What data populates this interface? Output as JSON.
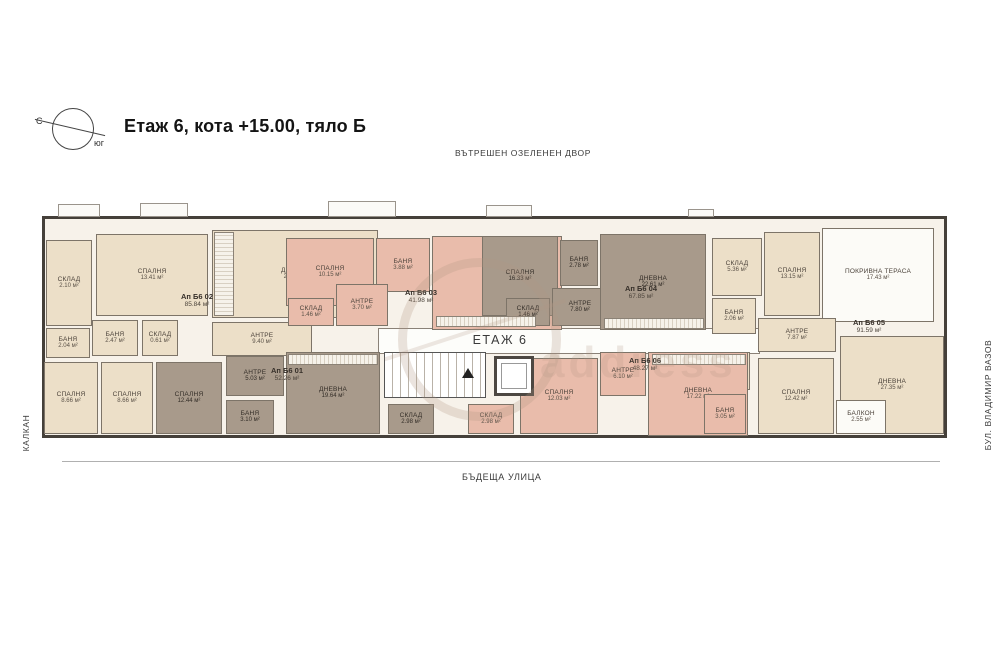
{
  "header": {
    "compass_north": "С",
    "compass_south": "юг",
    "title": "Етаж 6, кота +15.00, тяло Б"
  },
  "surroundings": {
    "top": "ВЪТРЕШЕН ОЗЕЛЕНЕН ДВОР",
    "bottom": "БЪДЕЩА УЛИЦА",
    "left": "КАЛКАН",
    "right": "БУЛ. ВЛАДИМИР ВАЗОВ"
  },
  "core": {
    "floor_label": "ЕТАЖ 6"
  },
  "watermark": "address",
  "colors": {
    "cream": "#ecdfc8",
    "salmon": "#e9bcab",
    "taupe": "#a89a8b",
    "wall": "#45403a"
  },
  "apartments": [
    {
      "id": "Ап Б6 01",
      "total_area": "52.26 м²",
      "rooms": [
        {
          "name": "СПАЛНЯ",
          "area": "12.44 м²"
        },
        {
          "name": "АНТРЕ",
          "area": "5.03 м²"
        },
        {
          "name": "БАНЯ",
          "area": "3.10 м²"
        },
        {
          "name": "ДНЕВНА",
          "area": "19.64 м²"
        },
        {
          "name": "СКЛАД",
          "area": "2.98 м²"
        }
      ]
    },
    {
      "id": "Ап Б6 02",
      "total_area": "85.84 м²",
      "rooms": [
        {
          "name": "СКЛАД",
          "area": "2.10 м²"
        },
        {
          "name": "СПАЛНЯ",
          "area": "13.41 м²"
        },
        {
          "name": "ДНЕВНА",
          "area": "22.98 м²"
        },
        {
          "name": "БАНЯ",
          "area": "2.47 м²"
        },
        {
          "name": "СКЛАД",
          "area": "0.61 м²"
        },
        {
          "name": "АНТРЕ",
          "area": "9.40 м²"
        },
        {
          "name": "БАНЯ",
          "area": "2.04 м²"
        },
        {
          "name": "СПАЛНЯ",
          "area": "8.66 м²"
        },
        {
          "name": "СПАЛНЯ",
          "area": "8.66 м²"
        }
      ]
    },
    {
      "id": "Ап Б6 03",
      "total_area": "41.98 м²",
      "rooms": [
        {
          "name": "СПАЛНЯ",
          "area": "10.15 м²"
        },
        {
          "name": "БАНЯ",
          "area": "3.88 м²"
        },
        {
          "name": "СКЛАД",
          "area": "1.46 м²"
        },
        {
          "name": "АНТРЕ",
          "area": "3.70 м²"
        },
        {
          "name": "ДНЕВНА",
          "area": "17.22 м²"
        }
      ]
    },
    {
      "id": "Ап Б6 04",
      "total_area": "67.85 м²",
      "rooms": [
        {
          "name": "СПАЛНЯ",
          "area": "16.33 м²"
        },
        {
          "name": "БАНЯ",
          "area": "2.78 м²"
        },
        {
          "name": "СКЛАД",
          "area": "1.46 м²"
        },
        {
          "name": "АНТРЕ",
          "area": "7.80 м²"
        },
        {
          "name": "ДНЕВНА",
          "area": "22.61 м²"
        }
      ]
    },
    {
      "id": "Ап Б6 05",
      "total_area": "91.59 м²",
      "rooms": [
        {
          "name": "СКЛАД",
          "area": "5.36 м²"
        },
        {
          "name": "СПАЛНЯ",
          "area": "13.15 м²"
        },
        {
          "name": "БАНЯ",
          "area": "2.06 м²"
        },
        {
          "name": "ПОКРИВНА ТЕРАСА",
          "area": "17.43 м²"
        },
        {
          "name": "АНТРЕ",
          "area": "7.87 м²"
        },
        {
          "name": "БАНЯ",
          "area": "3.51 м²"
        },
        {
          "name": "СПАЛНЯ",
          "area": "12.42 м²"
        },
        {
          "name": "БАЛКОН",
          "area": "2.55 м²"
        },
        {
          "name": "ДНЕВНА",
          "area": "27.35 м²"
        }
      ]
    },
    {
      "id": "Ап Б6 06",
      "total_area": "48.27 м²",
      "rooms": [
        {
          "name": "СПАЛНЯ",
          "area": "12.03 м²"
        },
        {
          "name": "АНТРЕ",
          "area": "6.10 м²"
        },
        {
          "name": "ДНЕВНА",
          "area": "17.22 м²"
        },
        {
          "name": "БАНЯ",
          "area": "3.05 м²"
        },
        {
          "name": "СКЛАД",
          "area": "2.98 м²"
        }
      ]
    }
  ]
}
